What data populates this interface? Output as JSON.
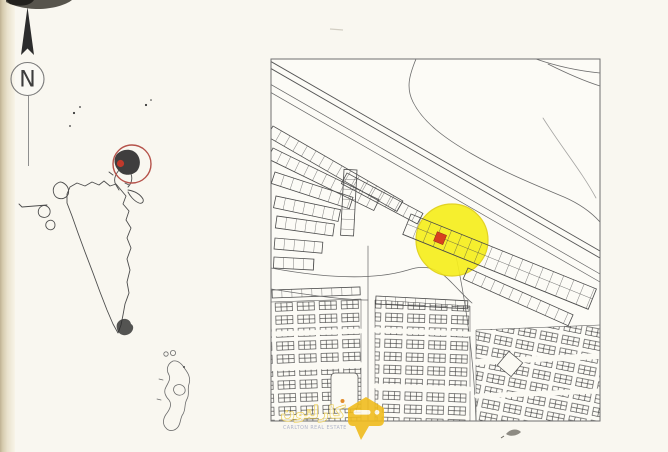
{
  "compass": {
    "label": "N"
  },
  "overview_map": {
    "highlight_ring_color": "#b5524a",
    "marker_color": "#c0392b"
  },
  "site_plan": {
    "highlight_circle_color": "#f6ee1e",
    "highlight_ring_color": "#e0d014",
    "highlighted_plot_color": "#d8401f"
  },
  "watermark": {
    "arabic_name": "كارلتون",
    "latin_name": "CARLTON REAL ESTATE",
    "bubble_color": "#f0bc1e",
    "accent_dot_color": "#e08218"
  }
}
